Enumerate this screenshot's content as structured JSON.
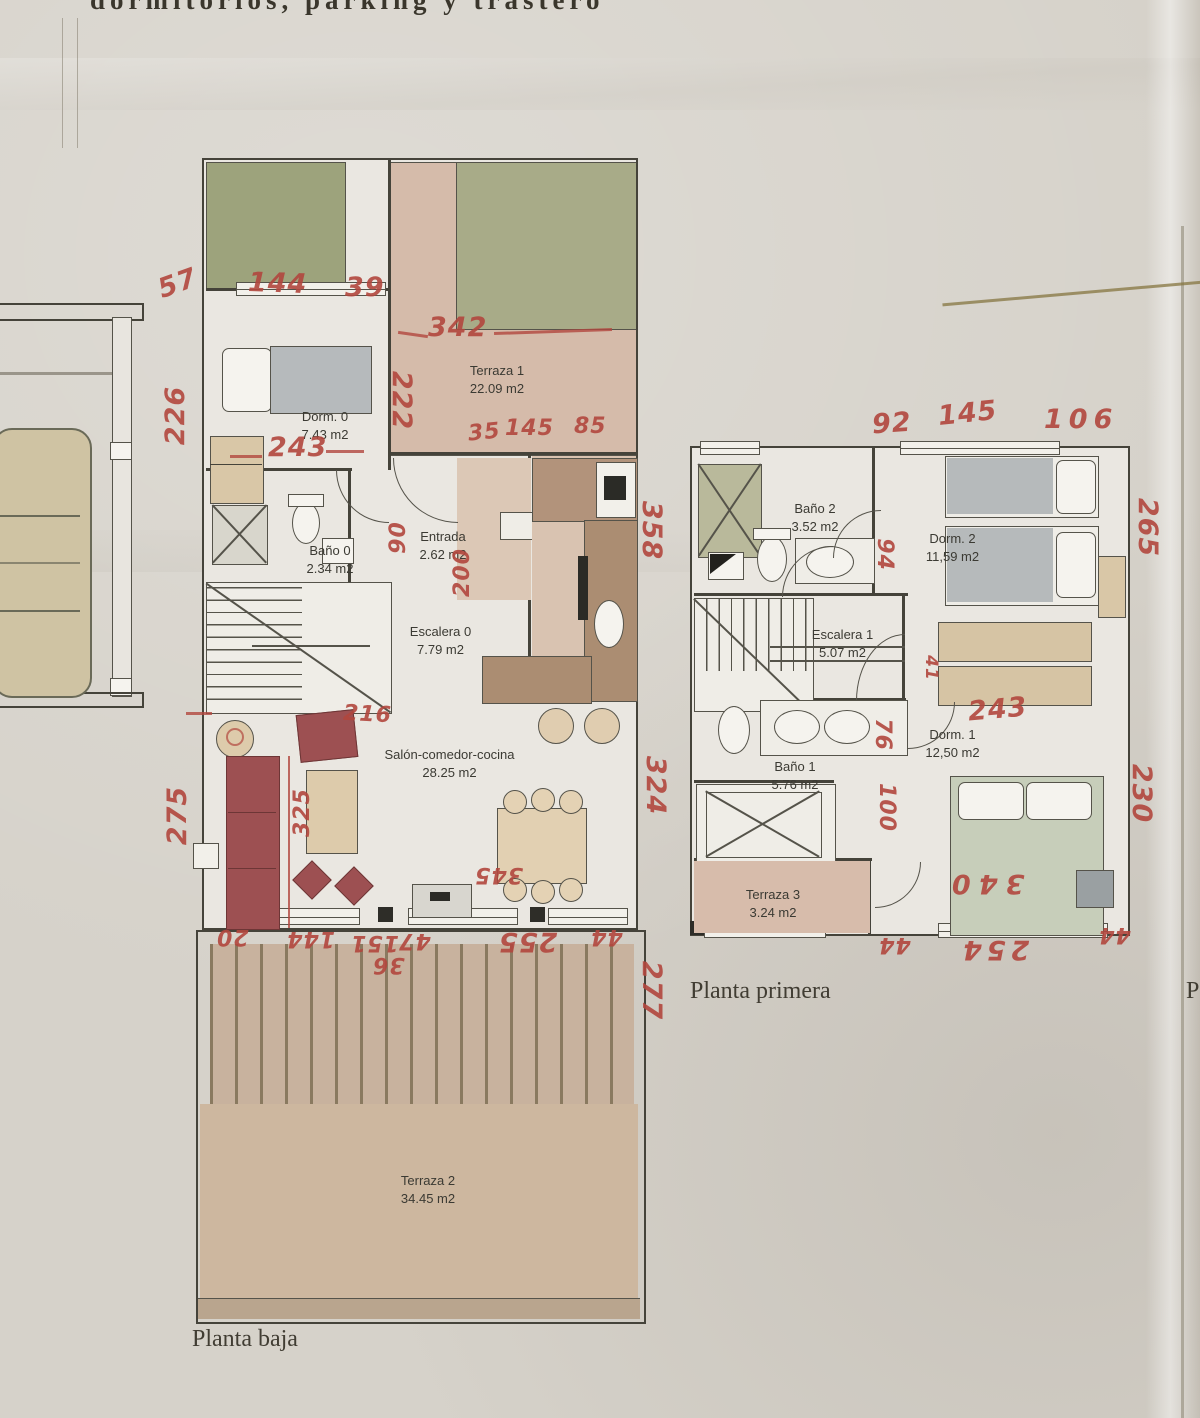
{
  "header": {
    "text": "dormitorios, parking y trastero"
  },
  "gf": {
    "caption": "Planta baja",
    "rooms": {
      "terraza1": {
        "name": "Terraza 1",
        "area": "22.09 m2"
      },
      "dorm0": {
        "name": "Dorm. 0",
        "area": "7.43 m2"
      },
      "bano0": {
        "name": "Baño 0",
        "area": "2.34 m2"
      },
      "entrada": {
        "name": "Entrada",
        "area": "2.62 m2"
      },
      "escalera0": {
        "name": "Escalera 0",
        "area": "7.79 m2"
      },
      "salon": {
        "name": "Salón-comedor-cocina",
        "area": "28.25 m2"
      },
      "terraza2": {
        "name": "Terraza 2",
        "area": "34.45 m2"
      }
    },
    "meas": {
      "top1": "57",
      "top2": "144",
      "top3": "39",
      "terr_w": "342",
      "terr_h": "222",
      "left_h": "226",
      "bed_w": "243",
      "win1": "35",
      "win2": "145",
      "win3": "85",
      "hall_w": "90",
      "kitchen_h": "200",
      "stair_w": "216",
      "salon_h": "275",
      "salon_w": "325",
      "right_h1": "358",
      "right_h2": "324",
      "door_b": "345",
      "bot1": "20",
      "bot2": "144",
      "bot3": "151",
      "bot4": "47",
      "bot5": "36",
      "bot6": "255",
      "bot7": "44",
      "terr2_h": "277"
    }
  },
  "ff": {
    "caption": "Planta primera",
    "rooms": {
      "bano2": {
        "name": "Baño 2",
        "area": "3.52 m2"
      },
      "dorm2": {
        "name": "Dorm. 2",
        "area": "11,59 m2"
      },
      "escalera1": {
        "name": "Escalera 1",
        "area": "5.07 m2"
      },
      "dorm1": {
        "name": "Dorm. 1",
        "area": "12,50 m2"
      },
      "bano1": {
        "name": "Baño 1",
        "area": "5.76 m2"
      },
      "terraza3": {
        "name": "Terraza 3",
        "area": "3.24 m2"
      }
    },
    "meas": {
      "top1": "92",
      "top2": "145",
      "top3": "106",
      "right_h1": "265",
      "right_h2": "230",
      "door1": "94",
      "door2": "41",
      "door3": "76",
      "door4": "100",
      "ward_w": "243",
      "bed_w": "340",
      "bot1": "44",
      "bot2": "254",
      "bot3": "44"
    }
  },
  "edge": {
    "partial": "P"
  }
}
